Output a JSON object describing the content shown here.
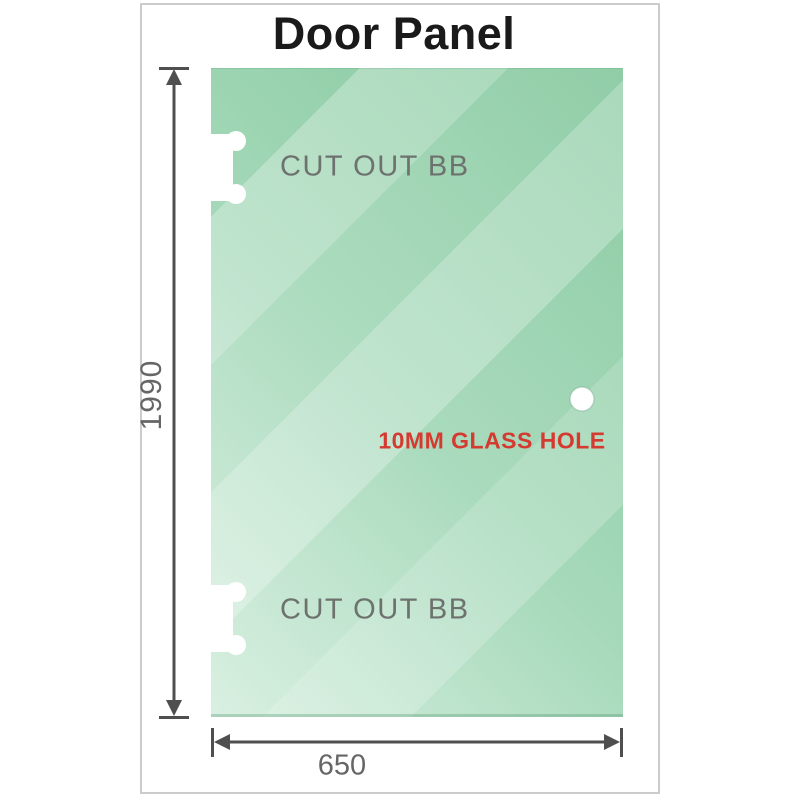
{
  "labels": {
    "title": "Door Panel",
    "cutout_top": "CUT OUT BB",
    "cutout_bottom": "CUT OUT BB",
    "glass_hole": "10MM GLASS HOLE",
    "height_mm": "1990",
    "width_mm": "650"
  },
  "colors": {
    "panel_green_dark": "#84c89d",
    "panel_green_mid": "#a6d9ba",
    "panel_green_light": "#d7efe0",
    "dim_line": "#4f4f4f",
    "dim_label_gray": "#666666",
    "cutout_label_gray": "#6d726e",
    "hole_label_red": "#d43a2f",
    "title_black": "#1a1a1a",
    "page_border_gray": "#cccccc",
    "cutout_white": "#ffffff"
  }
}
